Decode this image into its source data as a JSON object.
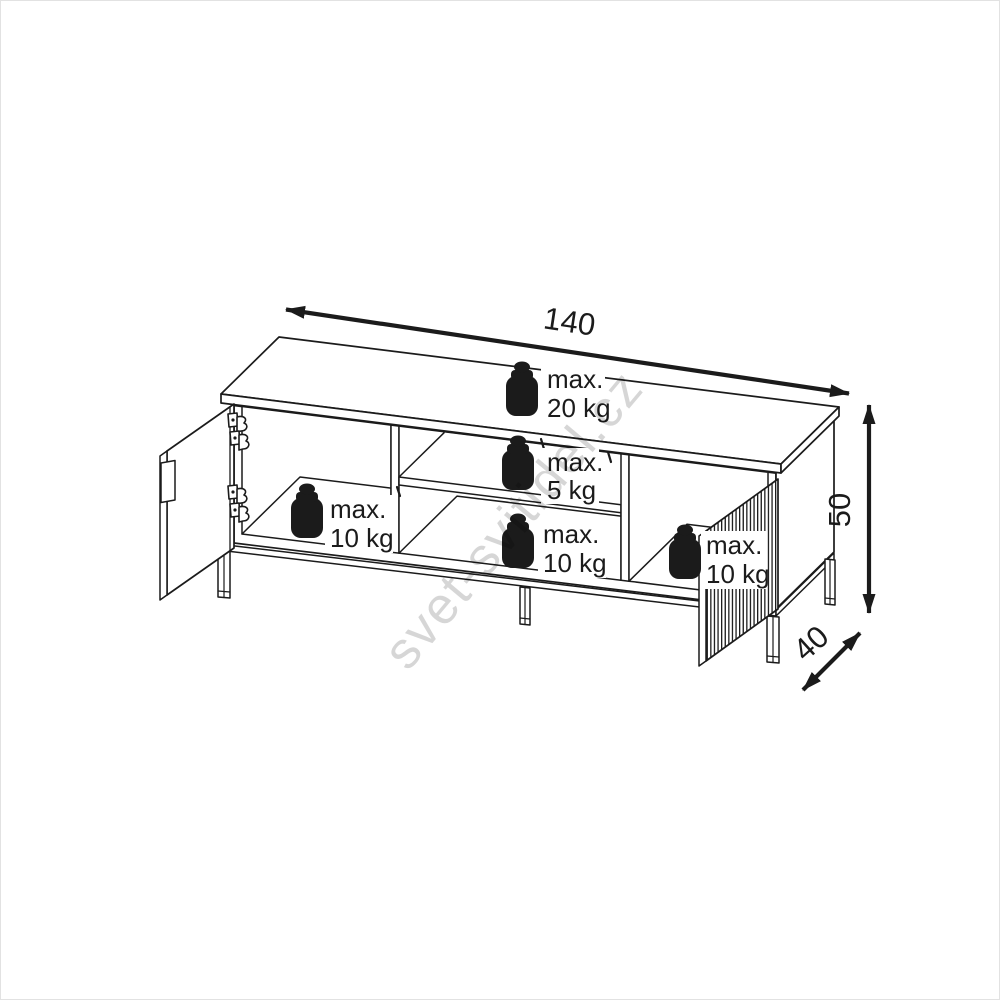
{
  "diagram": {
    "type": "furniture-technical-drawing",
    "item": "TV cabinet with open doors, shelf and metal legs",
    "dimensions": {
      "width": {
        "value": "140"
      },
      "height": {
        "value": "50"
      },
      "depth": {
        "value": "40"
      }
    },
    "max_load_labels": [
      {
        "id": "top",
        "line1": "max.",
        "line2": "20 kg"
      },
      {
        "id": "middle-shelf",
        "line1": "max.",
        "line2": "5 kg"
      },
      {
        "id": "left-compartment",
        "line1": "max.",
        "line2": "10 kg"
      },
      {
        "id": "middle-bottom",
        "line1": "max.",
        "line2": "10 kg"
      },
      {
        "id": "right-compartment",
        "line1": "max.",
        "line2": "10 kg"
      }
    ],
    "watermark": "svet-svitidel.cz",
    "colors": {
      "line": "#1b1b1b",
      "background": "#ffffff"
    }
  }
}
